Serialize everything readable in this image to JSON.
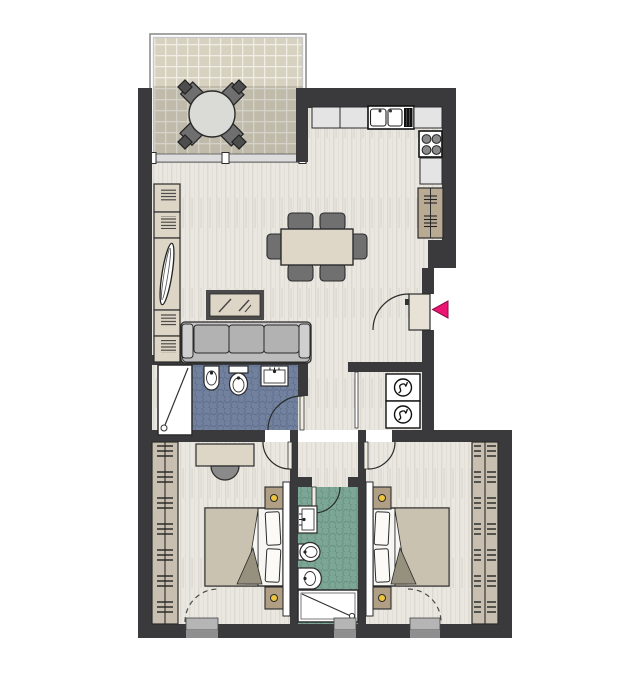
{
  "plan": {
    "type": "apartment-floor-plan",
    "entrance": {
      "marker": "magenta-arrow",
      "direction": "left"
    },
    "rooms": [
      {
        "name": "balcony",
        "floor": "tile-grid",
        "furniture": [
          "round-table",
          "chair x4"
        ]
      },
      {
        "name": "kitchen",
        "floor": "wood",
        "fixtures": [
          "counter x3",
          "double-sink",
          "stove-4-burners",
          "tall-cabinet"
        ]
      },
      {
        "name": "living-dining-room",
        "floor": "wood",
        "furniture": [
          "dining-table",
          "dining-chair x6",
          "sofa-3-seat",
          "coffee-table-glass",
          "bookshelf x4",
          "leaning-mirror"
        ]
      },
      {
        "name": "bathroom-main",
        "floor": "blue-hex-tile",
        "fixtures": [
          "shower",
          "bidet",
          "toilet",
          "sink"
        ]
      },
      {
        "name": "utility-closet",
        "appliances": [
          "washing-machine",
          "dryer"
        ]
      },
      {
        "name": "bedroom-left",
        "floor": "wood",
        "furniture": [
          "desk",
          "desk-chair",
          "double-bed",
          "nightstand x2",
          "lamp x2",
          "wardrobe"
        ]
      },
      {
        "name": "bathroom-ensuite",
        "floor": "green-hex-tile",
        "fixtures": [
          "sink",
          "toilet",
          "bidet",
          "shower"
        ]
      },
      {
        "name": "bedroom-right",
        "floor": "wood",
        "furniture": [
          "double-bed",
          "nightstand x2",
          "lamp x2",
          "wardrobe"
        ]
      }
    ]
  },
  "counts": {
    "balcony_chairs": 4,
    "dining_chairs": 6,
    "sofa_seats": 3,
    "stove_burners": 4,
    "washers": 2,
    "beds": 2,
    "nightstands": 4,
    "lamps": 4,
    "bathrooms": 2,
    "thresholds": 3
  },
  "colors": {
    "wall": "#3a3a3c",
    "wood": "#eae7e1",
    "wood_stripe": "#ddd8d0",
    "balcony_tile": "#d7d1c0",
    "balcony_grout": "#f0ede5",
    "tile_blue": "#71819e",
    "tile_green": "#7ca695",
    "furniture_beige": "#ddd6c7",
    "sofa_gray": "#c0c0c0",
    "cushion_gray": "#b2b2b2",
    "chair_gray": "#707070",
    "wardrobe_tan": "#c9bfb0",
    "nightstand_tan": "#b09e85",
    "counter": "#e4e4e4",
    "cabinet_tan": "#b9aa94",
    "lamp": "#eec53e",
    "entrance_arrow": "#ec1574",
    "threshold_light": "#b5b5b5",
    "threshold_dark": "#8f8f8f",
    "outline": "#2b2b2b"
  },
  "icons": [
    "washer-drum-icon",
    "stove-burner-icon",
    "lamp-icon",
    "entrance-arrow-icon",
    "shower-drain-icon"
  ]
}
